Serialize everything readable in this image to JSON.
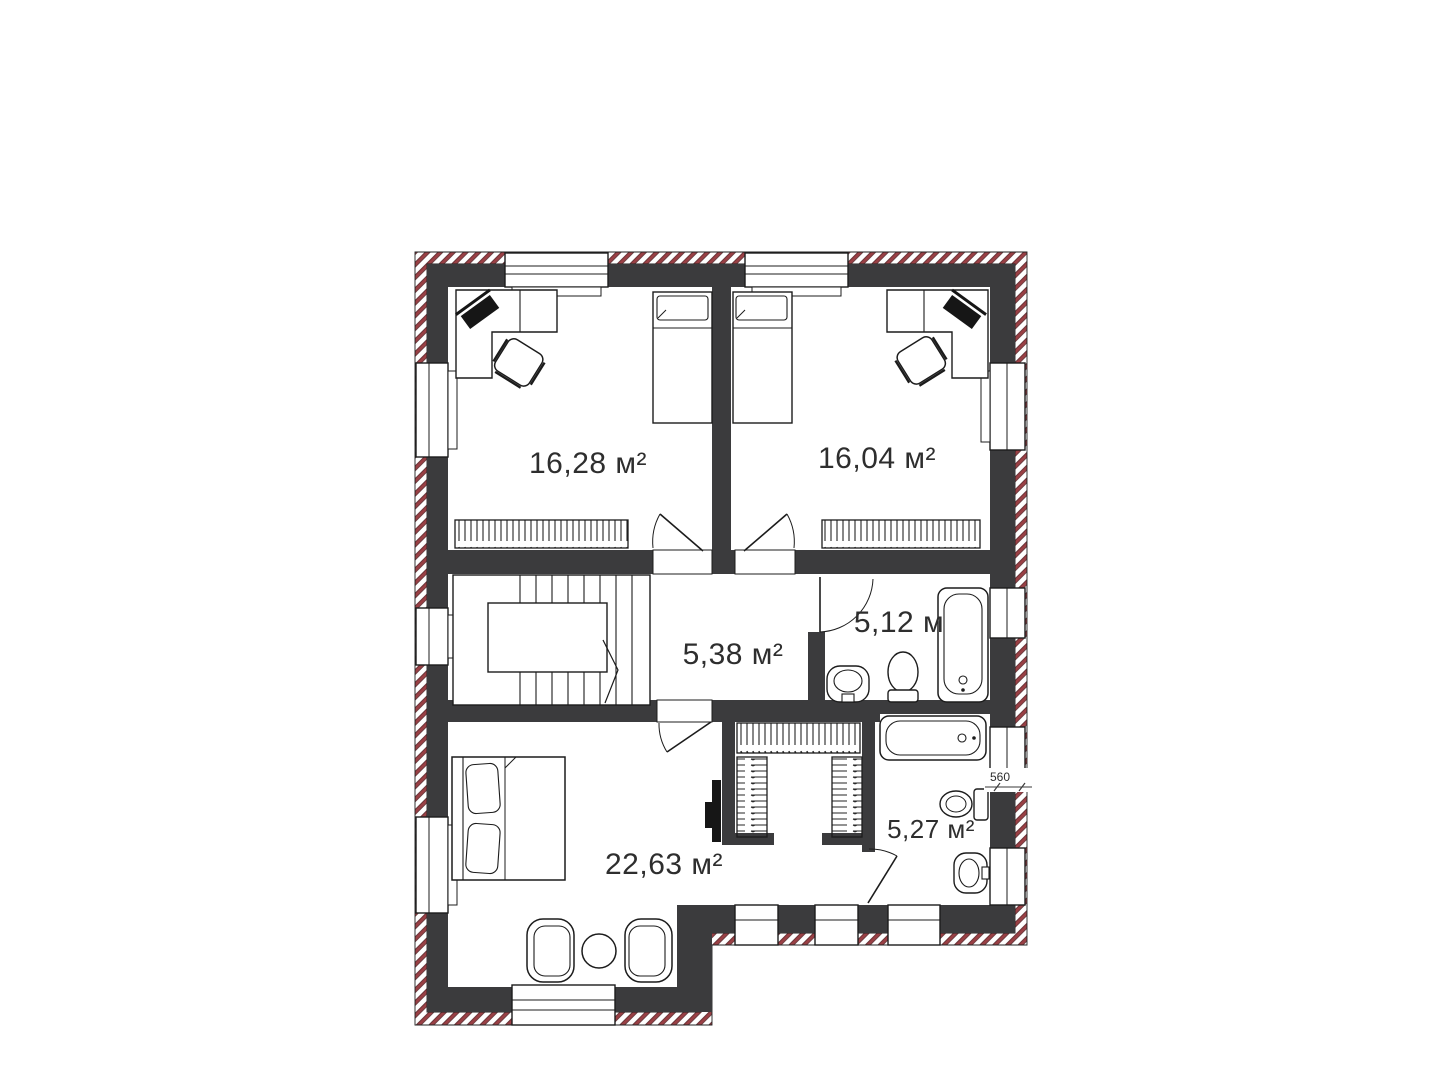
{
  "floor_plan": {
    "rooms": [
      {
        "id": "bedroom-top-left",
        "area_label": "16,28 м²"
      },
      {
        "id": "bedroom-top-right",
        "area_label": "16,04 м²"
      },
      {
        "id": "hallway",
        "area_label": "5,38 м²"
      },
      {
        "id": "bathroom-upper",
        "area_label": "5,12 м"
      },
      {
        "id": "bedroom-master",
        "area_label": "22,63 м²"
      },
      {
        "id": "bathroom-lower",
        "area_label": "5,27 м²"
      }
    ],
    "dimension_label": "560",
    "colors": {
      "wall_fill": "#3b3b3d",
      "hatch_stripe": "#9a4045",
      "line": "#1c1c1c",
      "label_text": "#2e2e2e",
      "background": "#ffffff"
    }
  }
}
